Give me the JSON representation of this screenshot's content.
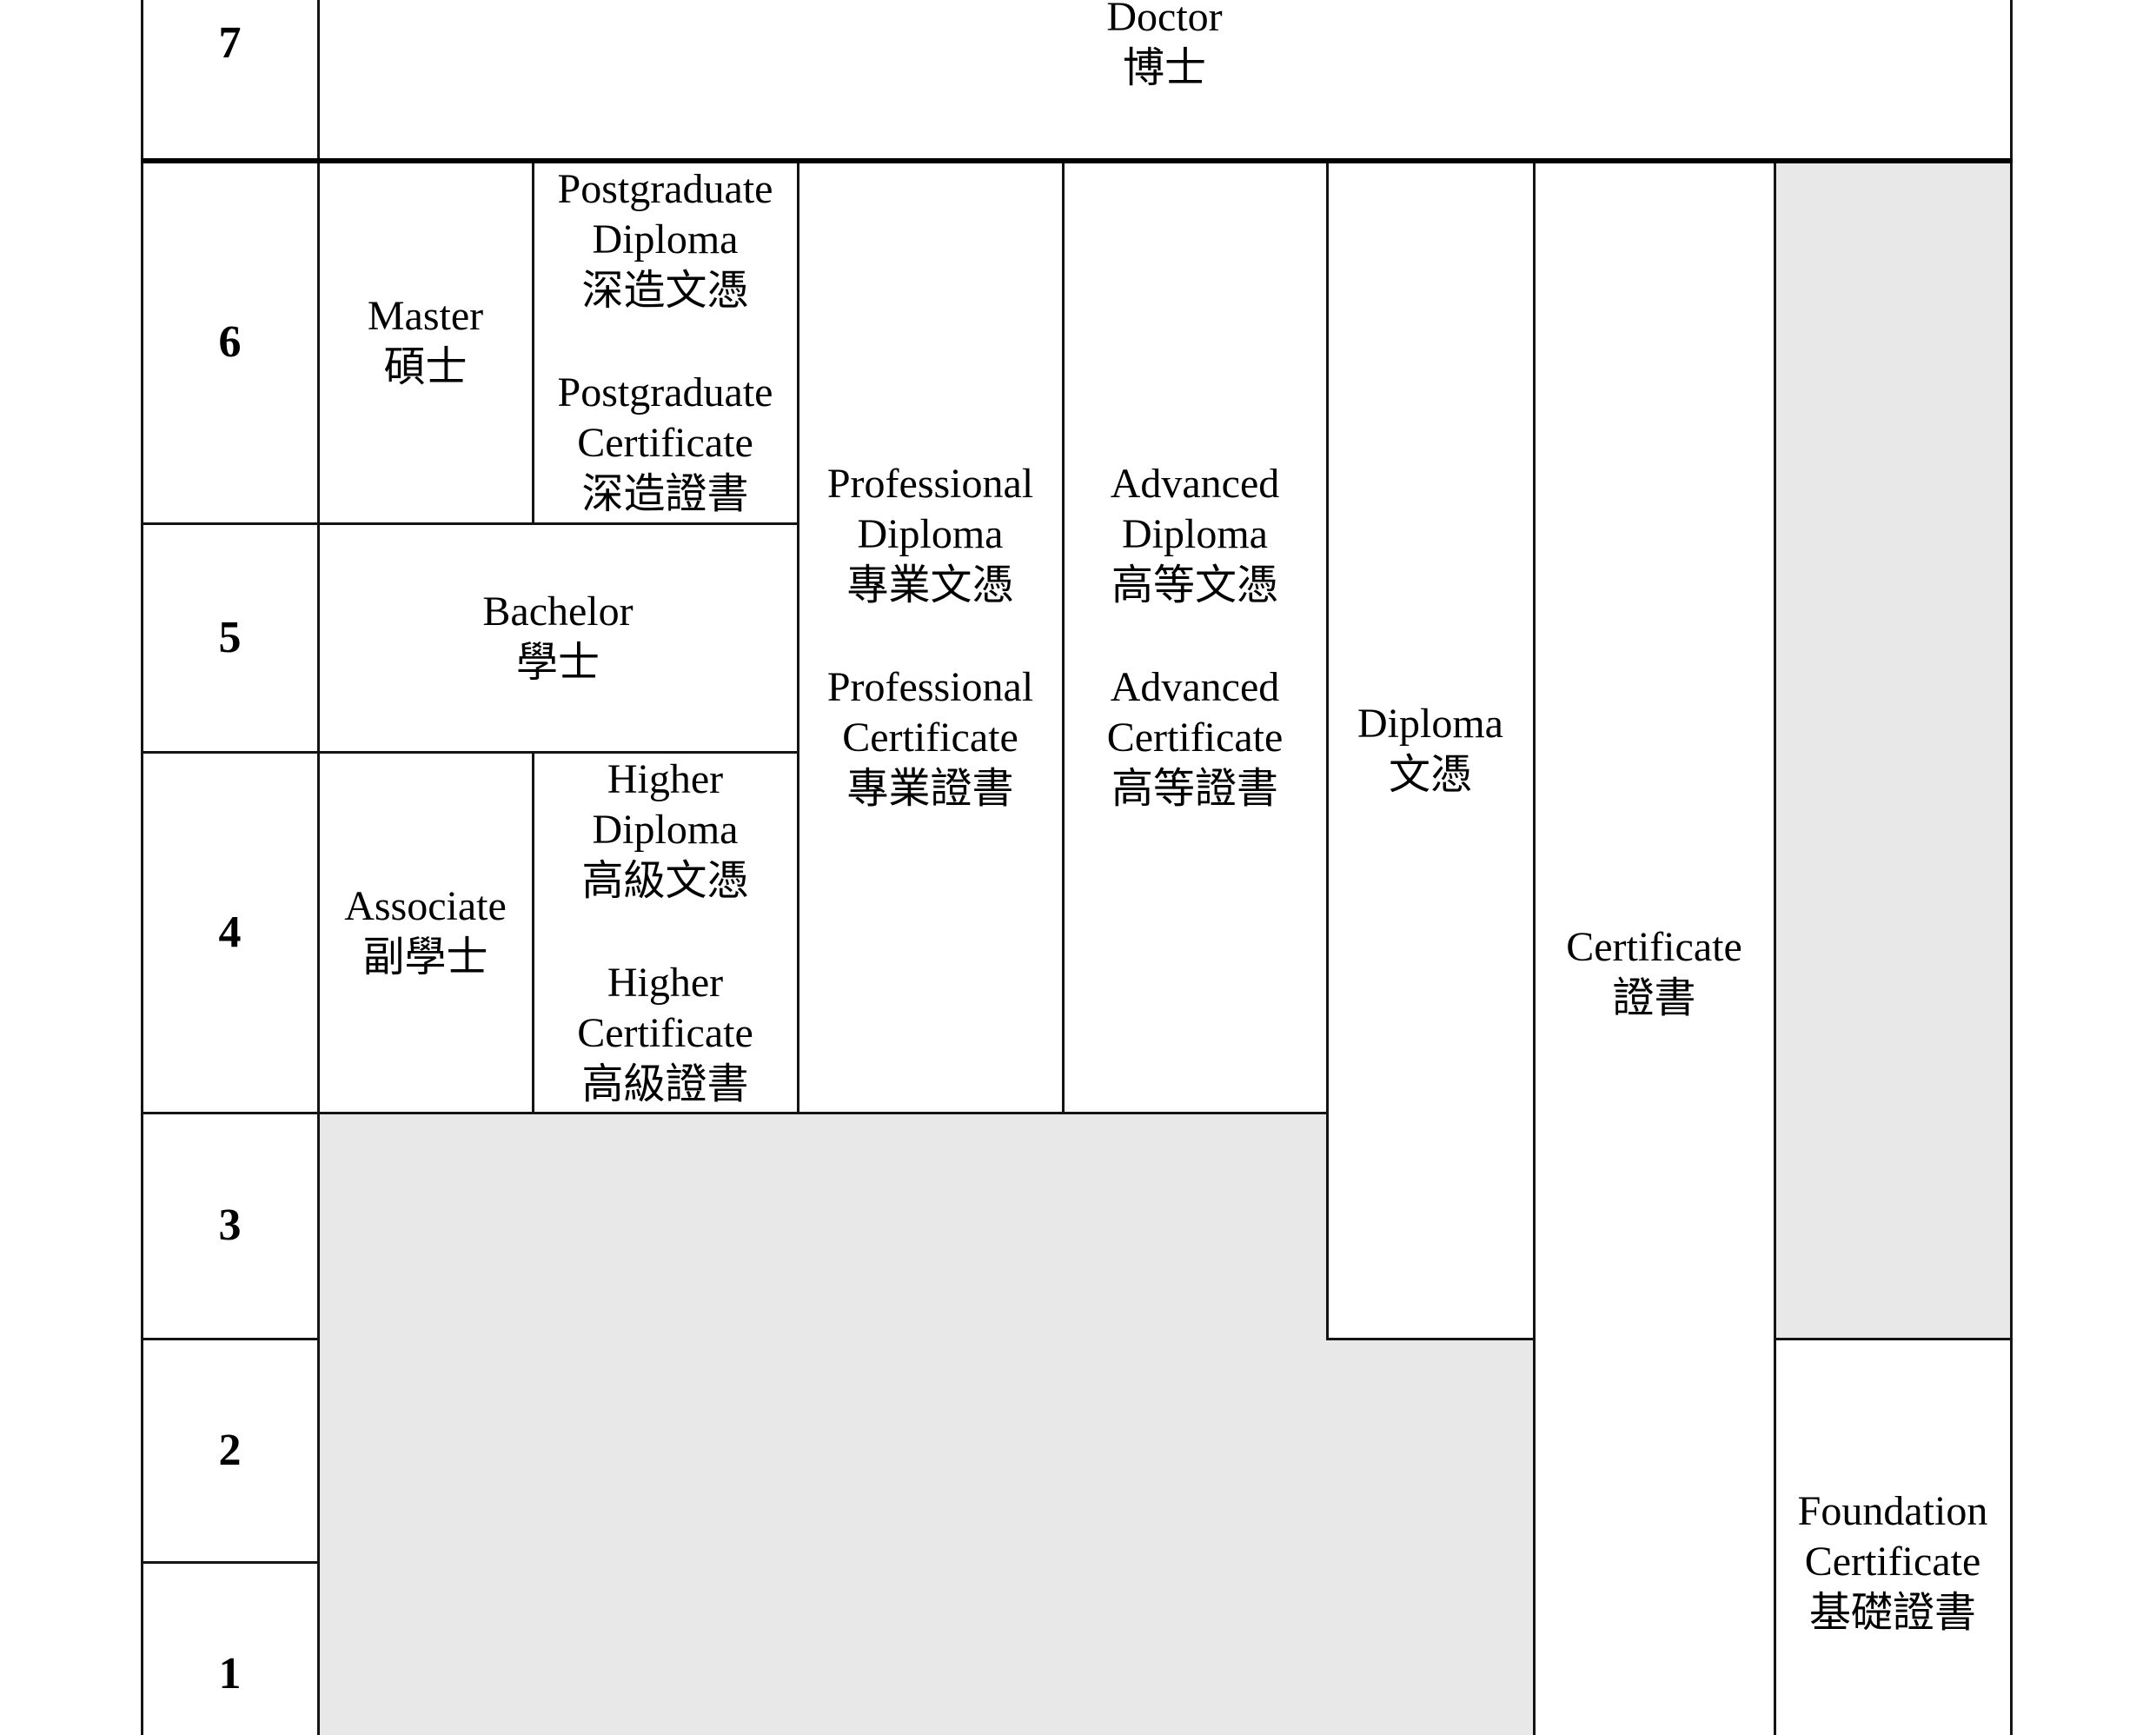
{
  "title": "Qualifications Framework levels table",
  "colors": {
    "shaded_region": "#e8e8e8",
    "grid_line": "#141414",
    "thick_line": "#000000",
    "text": "#000000",
    "background": "#ffffff"
  },
  "levels": {
    "l7": "7",
    "l6": "6",
    "l5": "5",
    "l4": "4",
    "l3": "3",
    "l2": "2",
    "l1": "1"
  },
  "cells": {
    "doctor": "Doctor\n博士",
    "master": "Master\n碩士",
    "postgraduate": "Postgraduate\nDiploma\n深造文憑\n\nPostgraduate\nCertificate\n深造證書",
    "bachelor": "Bachelor\n學士",
    "associate": "Associate\n副學士",
    "higher": "Higher\nDiploma\n高級文憑\n\nHigher\nCertificate\n高級證書",
    "professional": "Professional\nDiploma\n專業文憑\n\nProfessional\nCertificate\n專業證書",
    "advanced": "Advanced\nDiploma\n高等文憑\n\nAdvanced\nCertificate\n高等證書",
    "diploma": "Diploma\n文憑",
    "certificate": "Certificate\n證書",
    "foundation": "Foundation\nCertificate\n基礎證書"
  }
}
